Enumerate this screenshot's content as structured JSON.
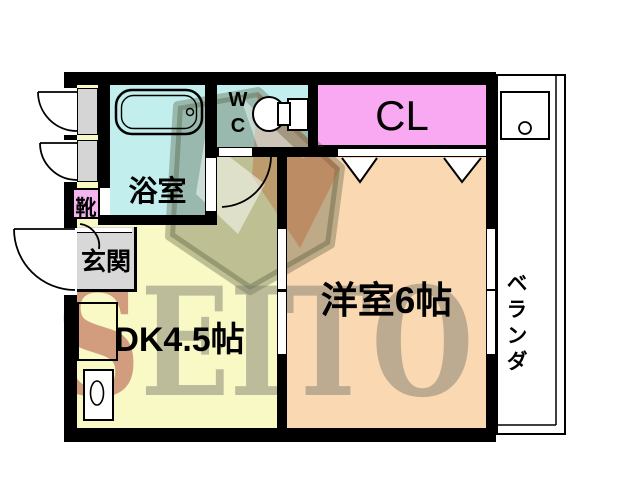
{
  "plan": {
    "type": "apartment-floorplan",
    "rooms": {
      "bathroom": {
        "label": "浴室",
        "color": "#c2efee"
      },
      "toilet": {
        "label_w": "W",
        "label_c": "C",
        "color": "#c2efee"
      },
      "closet": {
        "label": "CL",
        "color": "#f9a9f1"
      },
      "shoe_cabinet": {
        "label": "靴",
        "color": "#f4b4ee"
      },
      "entrance": {
        "label": "玄関",
        "color": "#d8d8d8"
      },
      "dining_kitchen": {
        "label": "DK4.5帖",
        "color": "#f9f9c5"
      },
      "western_room": {
        "label": "洋室6帖",
        "color": "#f9d8b2"
      },
      "veranda": {
        "label": "ベランダ",
        "color": "#ffffff"
      }
    },
    "fixtures": {
      "bathtub": "bathtub-icon",
      "toilet": "toilet-icon",
      "washing_machine_pan": "washing-machine-pan-icon",
      "kitchen_counter": "kitchen-counter-icon",
      "sink": "sink-icon",
      "closet_folding_doors": "folding-door-icon"
    },
    "wall_color": "#000000",
    "watermark": {
      "letter_first": "S",
      "letters_rest": "EITO",
      "first_color": "#9e2020",
      "rest_color": "#7a7a6a"
    }
  }
}
